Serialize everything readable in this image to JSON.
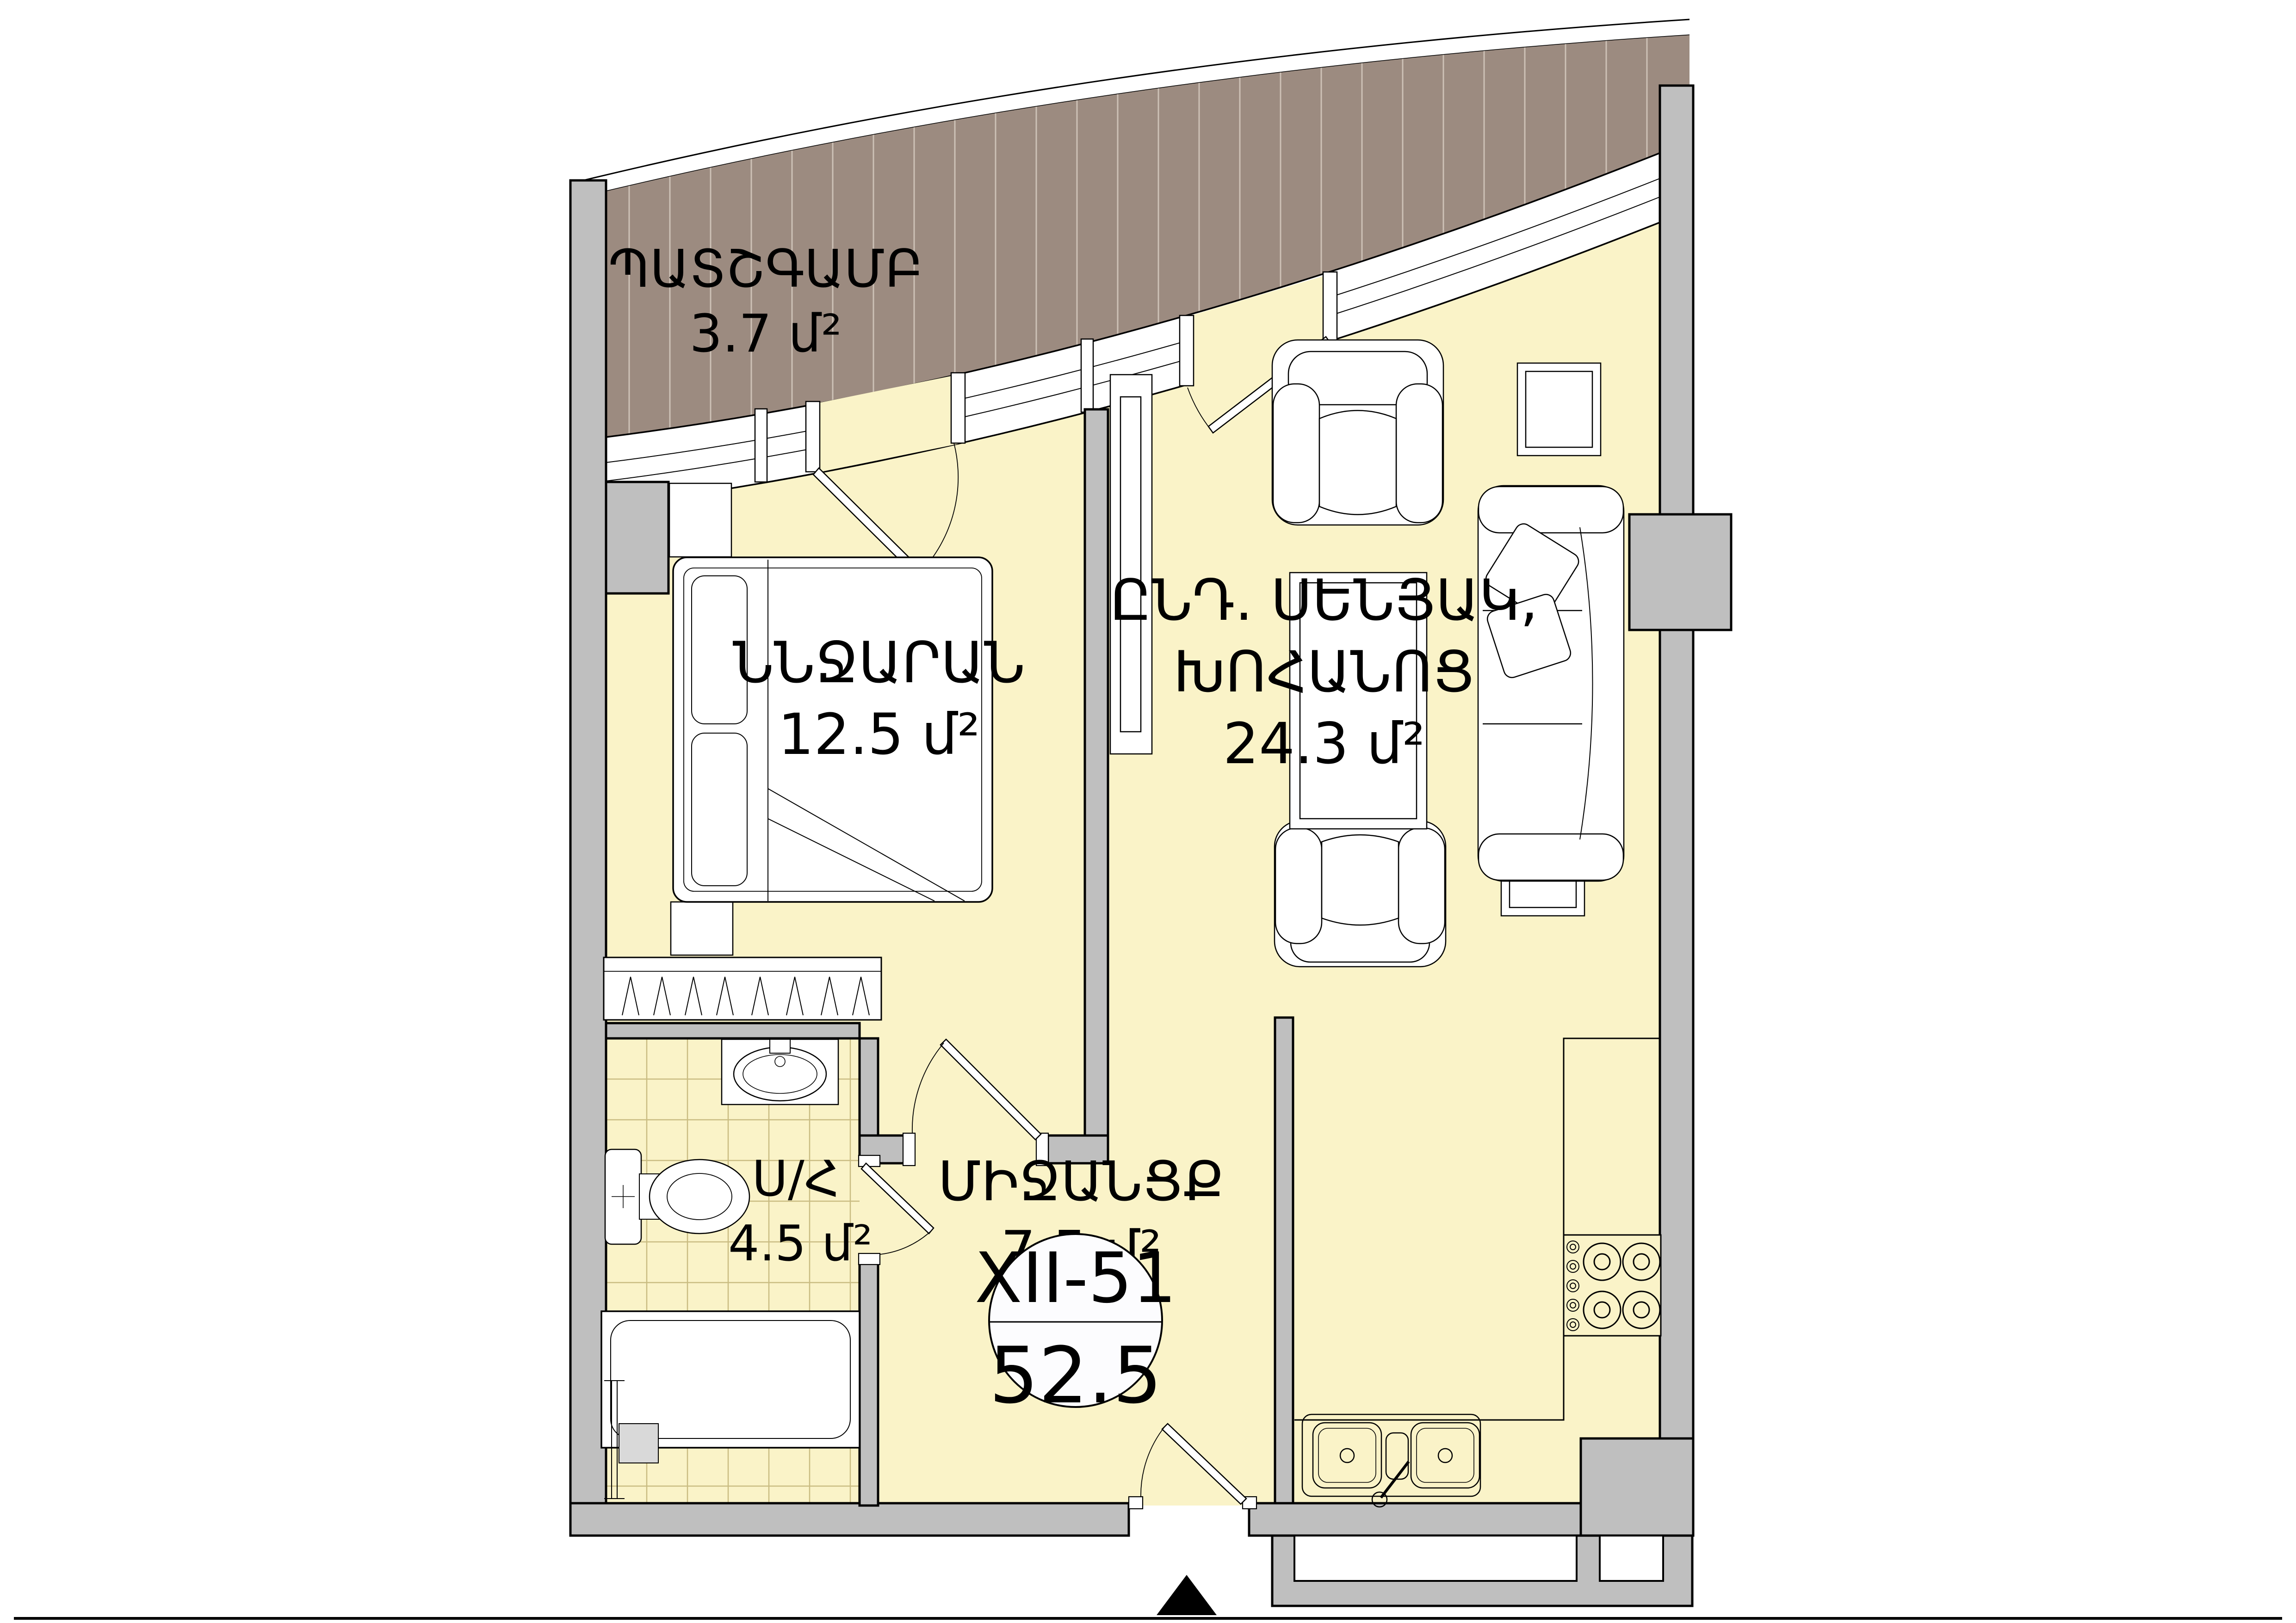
{
  "plan": {
    "type": "apartment-floor-plan",
    "unit": "մ²",
    "rooms": [
      {
        "id": "balcony",
        "name": "ՊԱՏՇԳԱՄԲ",
        "area": "3.7 մ²"
      },
      {
        "id": "bedroom",
        "name": "ՆՆՋԱՐԱՆ",
        "area": "12.5 մ²"
      },
      {
        "id": "living_kitchen",
        "name_line1": "ԸՆԴ. ՍԵՆՅԱԿ,",
        "name_line2": "ԽՈՀԱՆՈՑ",
        "area": "24.3 մ²"
      },
      {
        "id": "hallway",
        "name": "ՄԻՋԱՆՑՔ",
        "area": "7.5 մ²"
      },
      {
        "id": "bathroom",
        "name": "Ս/Հ",
        "area": "4.5 մ²"
      }
    ],
    "badge": {
      "apartment": "XII-51",
      "total_area": "52.5"
    },
    "colors": {
      "floor": "#FAF3C8",
      "wall": "#BFBFBF",
      "balcony_deck": "#9C8B80",
      "balcony_hatch": "#CDC1B6",
      "tile_line": "#C9BC82",
      "outline": "#000000"
    }
  }
}
